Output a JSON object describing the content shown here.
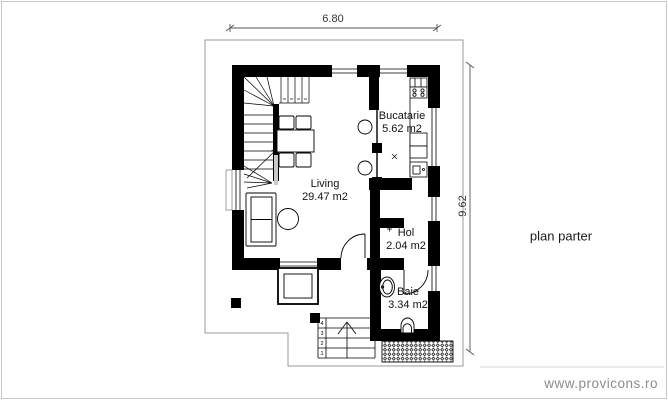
{
  "drawing": {
    "title": "plan parter",
    "watermark": "www.provicons.ro"
  },
  "dimensions": {
    "width": "6.80",
    "height": "9.62"
  },
  "rooms": [
    {
      "name": "Living",
      "area": "29.47 m2"
    },
    {
      "name": "Bucatarie",
      "area": "5.62 m2"
    },
    {
      "name": "Hol",
      "area": "2.04 m2"
    },
    {
      "name": "Baie",
      "area": "3.34 m2"
    }
  ],
  "entrance_steps": {
    "numbers": [
      "4",
      "3",
      "2",
      "1"
    ]
  },
  "colors": {
    "wall": "#000000",
    "line": "#1a1a1a",
    "lot_line": "#999999",
    "dimension": "#555555",
    "watermark": "#8c8c8c",
    "frame": "#c8c8c8"
  }
}
